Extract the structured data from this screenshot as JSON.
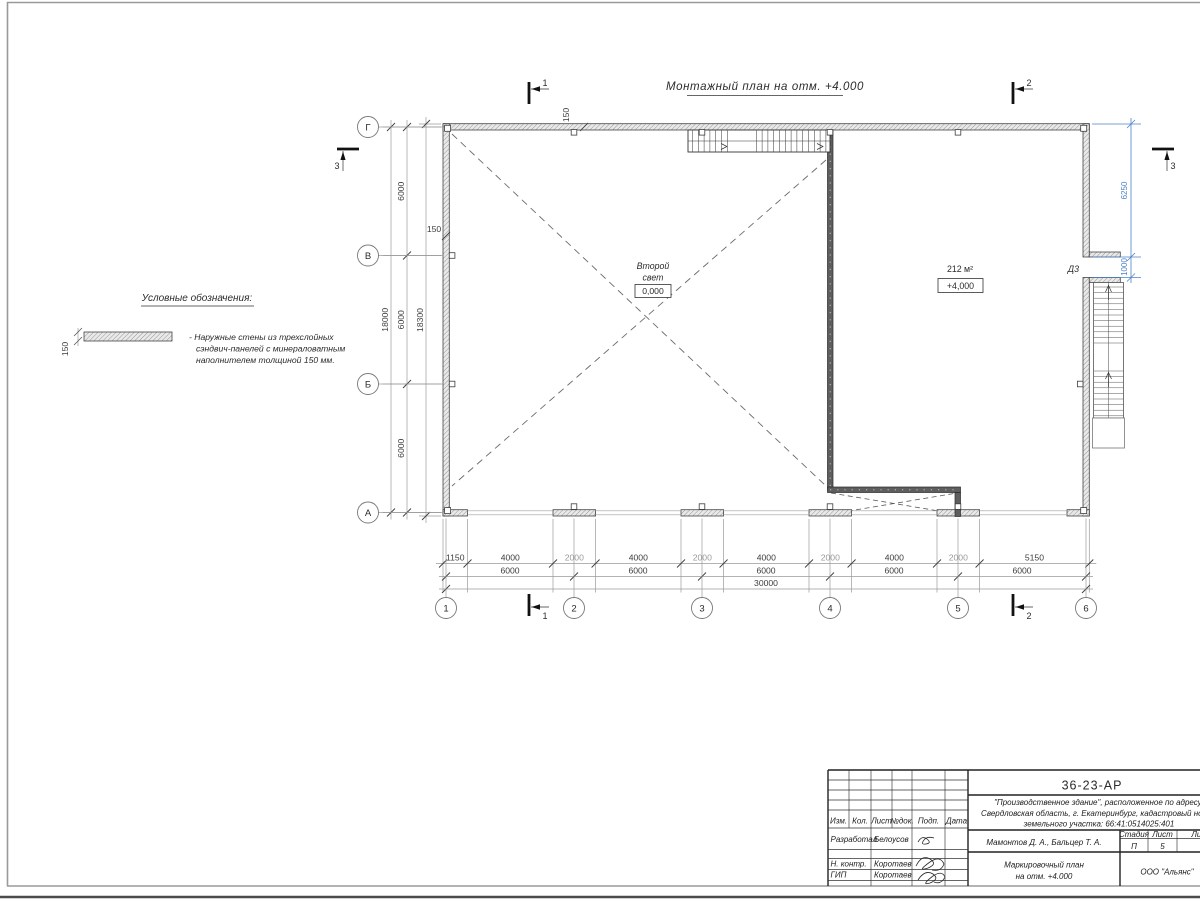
{
  "sheet": {
    "title": "Монтажный план на отм. +4.000"
  },
  "legend": {
    "heading": "Условные обозначения:",
    "thickness": "150",
    "note": [
      "- Наружные стены из трехслойных",
      "сэндвич-панелей с минераловатным",
      "наполнителем толщиной 150 мм."
    ]
  },
  "plan": {
    "column_axes": [
      "1",
      "2",
      "3",
      "4",
      "5",
      "6"
    ],
    "row_axes": [
      "Г",
      "В",
      "Б",
      "А"
    ],
    "section_labels": {
      "s1": "1",
      "s2": "2",
      "s3": "3"
    },
    "room_left": {
      "name1": "Второй",
      "name2": "свет",
      "elevation": "0,000"
    },
    "room_right": {
      "area": "212 м²",
      "elevation": "+4,000"
    },
    "door_label": "Д3",
    "wall_thickness_top": "150",
    "wall_thickness_left": "150",
    "dims_bottom_detail": [
      "1150",
      "4000",
      "2000",
      "4000",
      "2000",
      "4000",
      "2000",
      "4000",
      "2000",
      "5150"
    ],
    "dims_bottom_axes": [
      "6000",
      "6000",
      "6000",
      "6000",
      "6000"
    ],
    "dims_bottom_total": [
      "30000"
    ],
    "dims_left_axes": [
      "6000",
      "6000",
      "6000"
    ],
    "dims_left_total": "18000",
    "dims_left_outer": "18300",
    "dims_right_blue": [
      "6250",
      "1000"
    ]
  },
  "title_block": {
    "code": "36-23-АР",
    "project": [
      "\"Производственное здание\", расположенное по адресу:",
      "Свердловская область, г. Екатеринбург, кадастровый номер",
      "земельного участка: 66:41:0514025:401"
    ],
    "authors": "Мамонтов Д. А., Бальцер Т. А.",
    "doc_name": [
      "Маркировочный план",
      "на отм. +4.000"
    ],
    "company": "ООО \"Альянс\"",
    "stage_header": [
      "Стадия",
      "Лист",
      "Листов"
    ],
    "stage": "П",
    "sheet_no": "5",
    "cols_header": [
      "Изм.",
      "Кол.",
      "Лист",
      "№док.",
      "Подп.",
      "Дата"
    ],
    "rows": [
      {
        "role": "Разработал",
        "name": "Белоусов"
      },
      {
        "role": "Н. контр.",
        "name": "Коротаев"
      },
      {
        "role": "ГИП",
        "name": "Коротаев"
      }
    ]
  }
}
